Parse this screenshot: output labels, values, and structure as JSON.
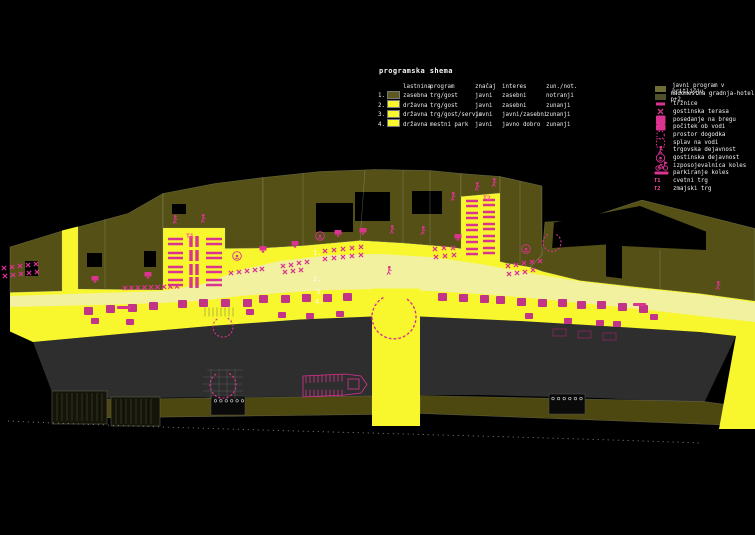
{
  "title": "programska shema",
  "legend_table": {
    "headers": [
      "lastnina",
      "program",
      "značaj",
      "interes",
      "zun./not."
    ],
    "rows": [
      {
        "num": "1.",
        "owner": "zasebna",
        "program": "trg/gost",
        "character": "javni",
        "interest": "zasebni",
        "orientation": "notranji"
      },
      {
        "num": "2.",
        "owner": "državna",
        "program": "trg/gost",
        "character": "javni",
        "interest": "zasebni",
        "orientation": "zunanji"
      },
      {
        "num": "3.",
        "owner": "državna",
        "program": "trg/gost/servis",
        "character": "javni",
        "interest": "javni/zasebni",
        "orientation": "zunanji"
      },
      {
        "num": "4.",
        "owner": "državna",
        "program": "mestni park",
        "character": "javni",
        "interest": "javno dobro",
        "orientation": "zunanji"
      }
    ]
  },
  "legend_items": [
    {
      "icon": "olive-swatch-icon",
      "label": "javni program v pritličju"
    },
    {
      "icon": "hotel-swatch-icon",
      "label": "nadomestna gradnja-hotel p+2"
    },
    {
      "icon": "market-bar-icon",
      "label": "tržnice"
    },
    {
      "icon": "terrace-x-icon",
      "label": "gostinska terasa"
    },
    {
      "icon": "bank-seating-icon",
      "label": "posedanje na bregu"
    },
    {
      "icon": "rest-by-water-icon",
      "label": "počitek ob vodi"
    },
    {
      "icon": "event-space-circle-icon",
      "label": "prostor dogodka"
    },
    {
      "icon": "raft-square-icon",
      "label": "splav na vodi"
    },
    {
      "icon": "commerce-figure-icon",
      "label": "trgovska dejavnost"
    },
    {
      "icon": "catering-circle-icon",
      "label": "gostinska dejavnost"
    },
    {
      "icon": "bike-rental-icon",
      "label": "izposojevalnica koles"
    },
    {
      "icon": "bike-parking-line-icon",
      "label": "parkiranje koles"
    },
    {
      "icon": "t1-icon",
      "label": "cvetni trg"
    },
    {
      "icon": "t2-icon",
      "label": "zmajski trg"
    }
  ],
  "map_labels": {
    "t1": "T1",
    "t2": "T2",
    "zones": [
      "1.",
      "2.",
      "3.",
      "4."
    ]
  },
  "colors": {
    "accent_pink": "#da3390",
    "bright_yellow": "#f8f72e",
    "pale_yellow": "#f1f1a0",
    "olive_building": "#555016",
    "dark_olive_hotel": "#50502a",
    "river_gray": "#2e2e2e",
    "far_bank_olive": "#4c480f",
    "background": "#000000"
  }
}
